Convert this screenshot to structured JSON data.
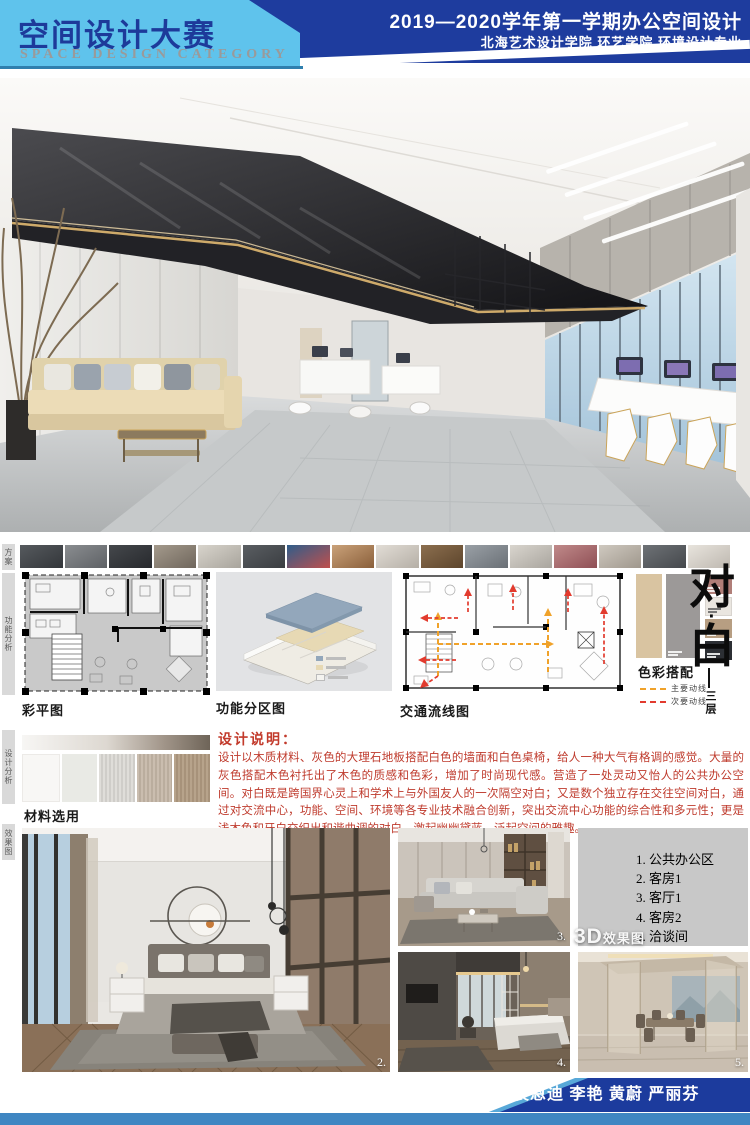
{
  "header": {
    "title_cn": "空间设计大赛",
    "title_en": "SPACE DESIGN CATEGORY",
    "course": "2019—2020学年第一学期办公空间设计",
    "school": "北海艺术设计学院  环艺学院  环境设计专业",
    "bar_color": "#1e3c9e",
    "panel_color": "#5fc3ec"
  },
  "sidebar": {
    "tabs": [
      "方案意向",
      "功能分析",
      "设计分析",
      "效果图"
    ]
  },
  "thumbnails": [
    "linear-gradient(150deg,#565a5e,#33363a)",
    "linear-gradient(150deg,#8a8d90,#5e6165)",
    "linear-gradient(150deg,#45484c,#27292d)",
    "linear-gradient(150deg,#a49a8c,#6f665c)",
    "linear-gradient(150deg,#d8d4cc,#a8a49c)",
    "linear-gradient(150deg,#5a5e62,#3a3d41)",
    "linear-gradient(150deg,#2f5d8a,#c0504d)",
    "linear-gradient(150deg,#caa27a,#8a5f3a)",
    "linear-gradient(150deg,#e2ddd6,#b5afa6)",
    "linear-gradient(150deg,#8c6f4f,#5d452c)",
    "linear-gradient(150deg,#9aa0a6,#6a7076)",
    "linear-gradient(150deg,#d9d5ce,#a9a59e)",
    "linear-gradient(150deg,#c08a8a,#8f4f55)",
    "linear-gradient(150deg,#cfc9c0,#9f978c)",
    "linear-gradient(150deg,#6e7276,#45484c)",
    "linear-gradient(150deg,#e8e4dd,#beb8b0)"
  ],
  "plans": {
    "color_plan_caption": "彩平图",
    "zoning_caption": "功能分区图",
    "circulation_caption": "交通流线图"
  },
  "zoning": {
    "legend_colors": [
      "#93a7bb",
      "#e7d9b4",
      "#f4f3ef"
    ]
  },
  "circulation_legend": {
    "items": [
      {
        "label": "主要动线",
        "color": "#f0a22a"
      },
      {
        "label": "次要动线",
        "color": "#e23b2e"
      }
    ]
  },
  "palette": {
    "caption": "色彩搭配",
    "large": [
      "#d9c4a1",
      "#9c9998"
    ],
    "small": [
      "#b07e78",
      "#eae6e0",
      "#b79e82",
      "#2c2f34"
    ]
  },
  "theme": {
    "char_top": "对",
    "dot": "·",
    "char_bottom": "白",
    "floor": "三层"
  },
  "materials": {
    "caption": "材料选用",
    "bar": "linear-gradient(90deg,#f7f6f4 0%,#ddd8d1 45%,#a2968a 75%,#6e6458 100%)",
    "swatches": [
      "#f8f7f5",
      "#e9eae5",
      "repeating-linear-gradient(90deg,#dfddd9 0 2px,#cfcdc9 2px 4px)",
      "repeating-linear-gradient(90deg,#cabdaf 0 2px,#baad9e 2px 4px)",
      "repeating-linear-gradient(90deg,#b7a38b 0 2px,#a7927a 2px 4px)"
    ]
  },
  "description": {
    "heading": "设计说明：",
    "body": "设计以木质材料、灰色的大理石地板搭配白色的墙面和白色桌椅，给人一种大气有格调的感觉。大量的灰色搭配木色衬托出了木色的质感和色彩，增加了时尚现代感。营造了一处灵动又怡人的公共办公空间。对白既是跨国界心灵上和学术上与外国友人的一次隔空对白；又是数个独立存在交往空间对白，通过对交流中心，功能、空间、环境等各专业技术融合创新，突出交流中心功能的综合性和多元性；更是浅木色和牙白交织出和谐曲调的对白，激起幽幽黛蓝，泛起空间的雅趣。"
  },
  "renders": {
    "label_3d": "3D",
    "label_3d_suffix": "效果图",
    "list": [
      "1. 公共办公区",
      "2. 客房1",
      "3. 客厅1",
      "4. 客房2",
      "5. 洽谈间"
    ],
    "corner_numbers": {
      "main": "2.",
      "living": "3.",
      "bed2": "4.",
      "meeting": "5."
    }
  },
  "footer": {
    "class_label": "班级：环本1707",
    "members": "组员：袁恩迪  李艳  黄蔚  严丽芬",
    "bar_color": "#1c3b9d",
    "strip_color": "#3f86c2"
  }
}
